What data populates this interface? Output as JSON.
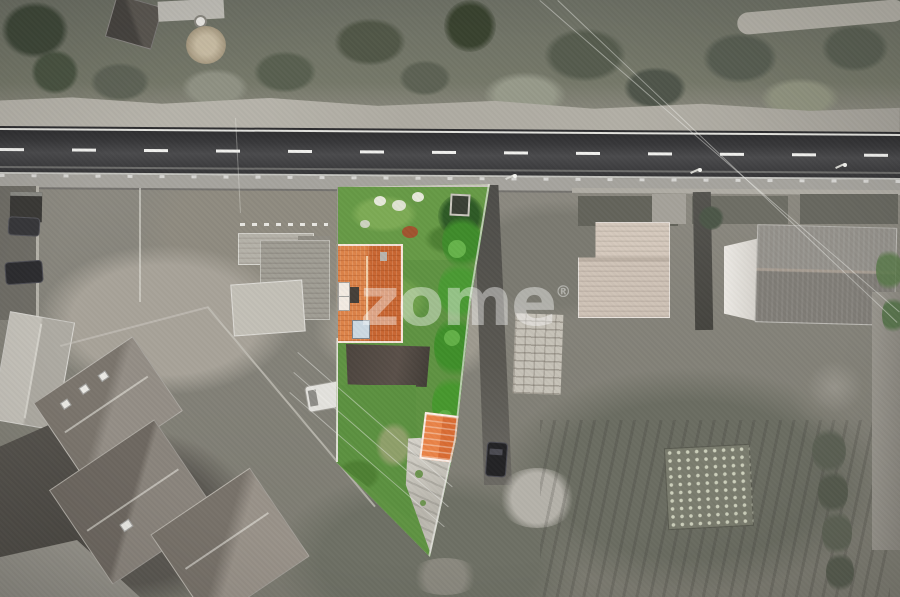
{
  "image": {
    "type": "aerial-drone-photograph",
    "subject": "real-estate plot highlight",
    "description": "Top-down drone photo of a village street; surroundings are desaturated to grayscale while the subject property is shown in color: green lawn, hedge, orange tiled main roof and small orange outbuilding, concrete driveway, beside a two-lane asphalt road."
  },
  "watermark": {
    "text": "zome",
    "registered_mark": "®"
  },
  "palette": {
    "lawn_green": "#5f9342",
    "hedge_green": "#3f8c2b",
    "roof_orange": "#d2703c",
    "outbuilding_orange": "#e57a40",
    "asphalt_dark": "#3a3a3d",
    "road_marking_white": "#f6f6f1",
    "sidewalk_gray": "#a6a49e",
    "ground_gray": "#8a887f",
    "dark_paving": "#55524d",
    "neutral_roof_gray": "#8e8a84",
    "beige_roof": "#cfc3b7"
  }
}
